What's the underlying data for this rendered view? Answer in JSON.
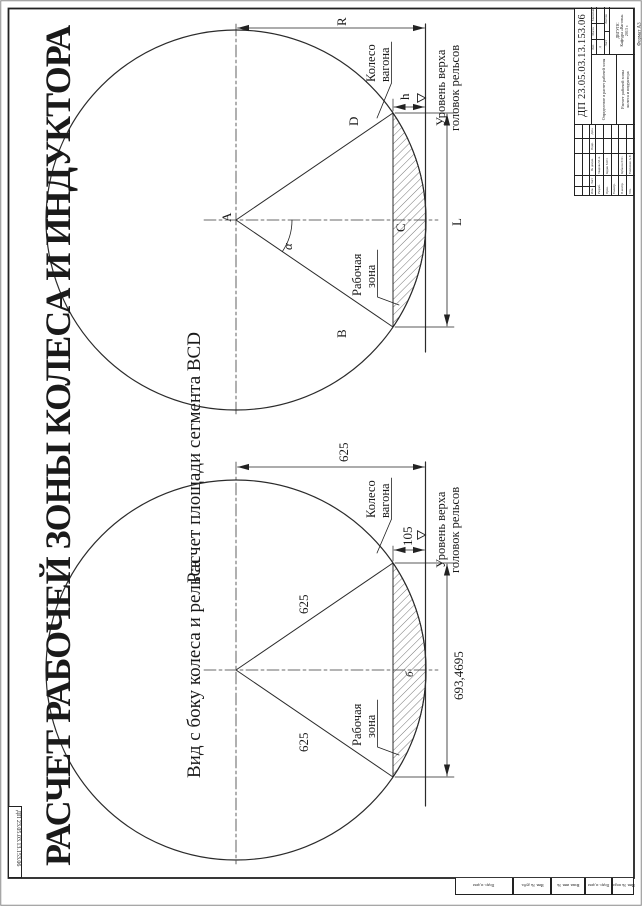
{
  "sheet": {
    "title": "РАСЧЕТ РАБОЧЕЙ ЗОНЫ КОЛЕСА И ИНДУКТОРА",
    "corner_designation": "ДП 23.05.03.13.153.06",
    "format_note": "Формат А3"
  },
  "segment_diagram": {
    "subtitle": "Расчет площади сегмента BCD",
    "point_a": "A",
    "point_b": "B",
    "point_c": "C",
    "point_d": "D",
    "dim_radius": "R",
    "dim_chord": "L",
    "dim_height": "h",
    "dim_angle": "α",
    "wheel_l1": "Колесо",
    "wheel_l2": "вагона",
    "zone_l1": "Рабочая",
    "zone_l2": "зона",
    "rail_l1": "Уровень верха",
    "rail_l2": "головок рельсов"
  },
  "side_diagram": {
    "subtitle": "Вид с боку колеса и рельса",
    "radius_value": "625",
    "chord_value": "693,4695",
    "height_value": "105",
    "point_center": "б",
    "wheel_l1": "Колесо",
    "wheel_l2": "вагона",
    "zone_l1": "Рабочая",
    "zone_l2": "зона",
    "rail_l1": "Уровень верха",
    "rail_l2": "головок рельсов"
  },
  "title_block": {
    "designation": "ДП 23.05.03.13.153.06",
    "theme": "Определение и расчет рабочей зоны",
    "doc_name_l1": "Расчет рабочей зоны",
    "doc_name_l2": "колеса и индуктора",
    "col_izm": "Изм.",
    "col_list": "Лист",
    "col_doc": "№ докум.",
    "col_sign": "Подп.",
    "col_date": "Дата",
    "rows": [
      {
        "role": "Разраб.",
        "name": "Уварова М.А."
      },
      {
        "role": "Пров.",
        "name": "Кудин М.Ю."
      },
      {
        "role": "Т.контр.",
        "name": ""
      },
      {
        "role": "Н.контр.",
        "name": "Кубасов Ю.С."
      },
      {
        "role": "Утв.",
        "name": "Тимченко А.В."
      }
    ],
    "lit_label": "Лит.",
    "lit_value": "Д",
    "mass_label": "Масса",
    "scale_label": "Масштаб",
    "sheet_label": "Лист",
    "sheets_label": "Листов",
    "org_l1": "ДВГУПС",
    "org_l2": "Кафедра «Вагоны»",
    "org_l3": "2013 г."
  },
  "margin_stamps": [
    "Подп. и дата",
    "Инв. № дубл.",
    "Взам. инв. №",
    "Подп. и дата",
    "Инв. № подл."
  ]
}
